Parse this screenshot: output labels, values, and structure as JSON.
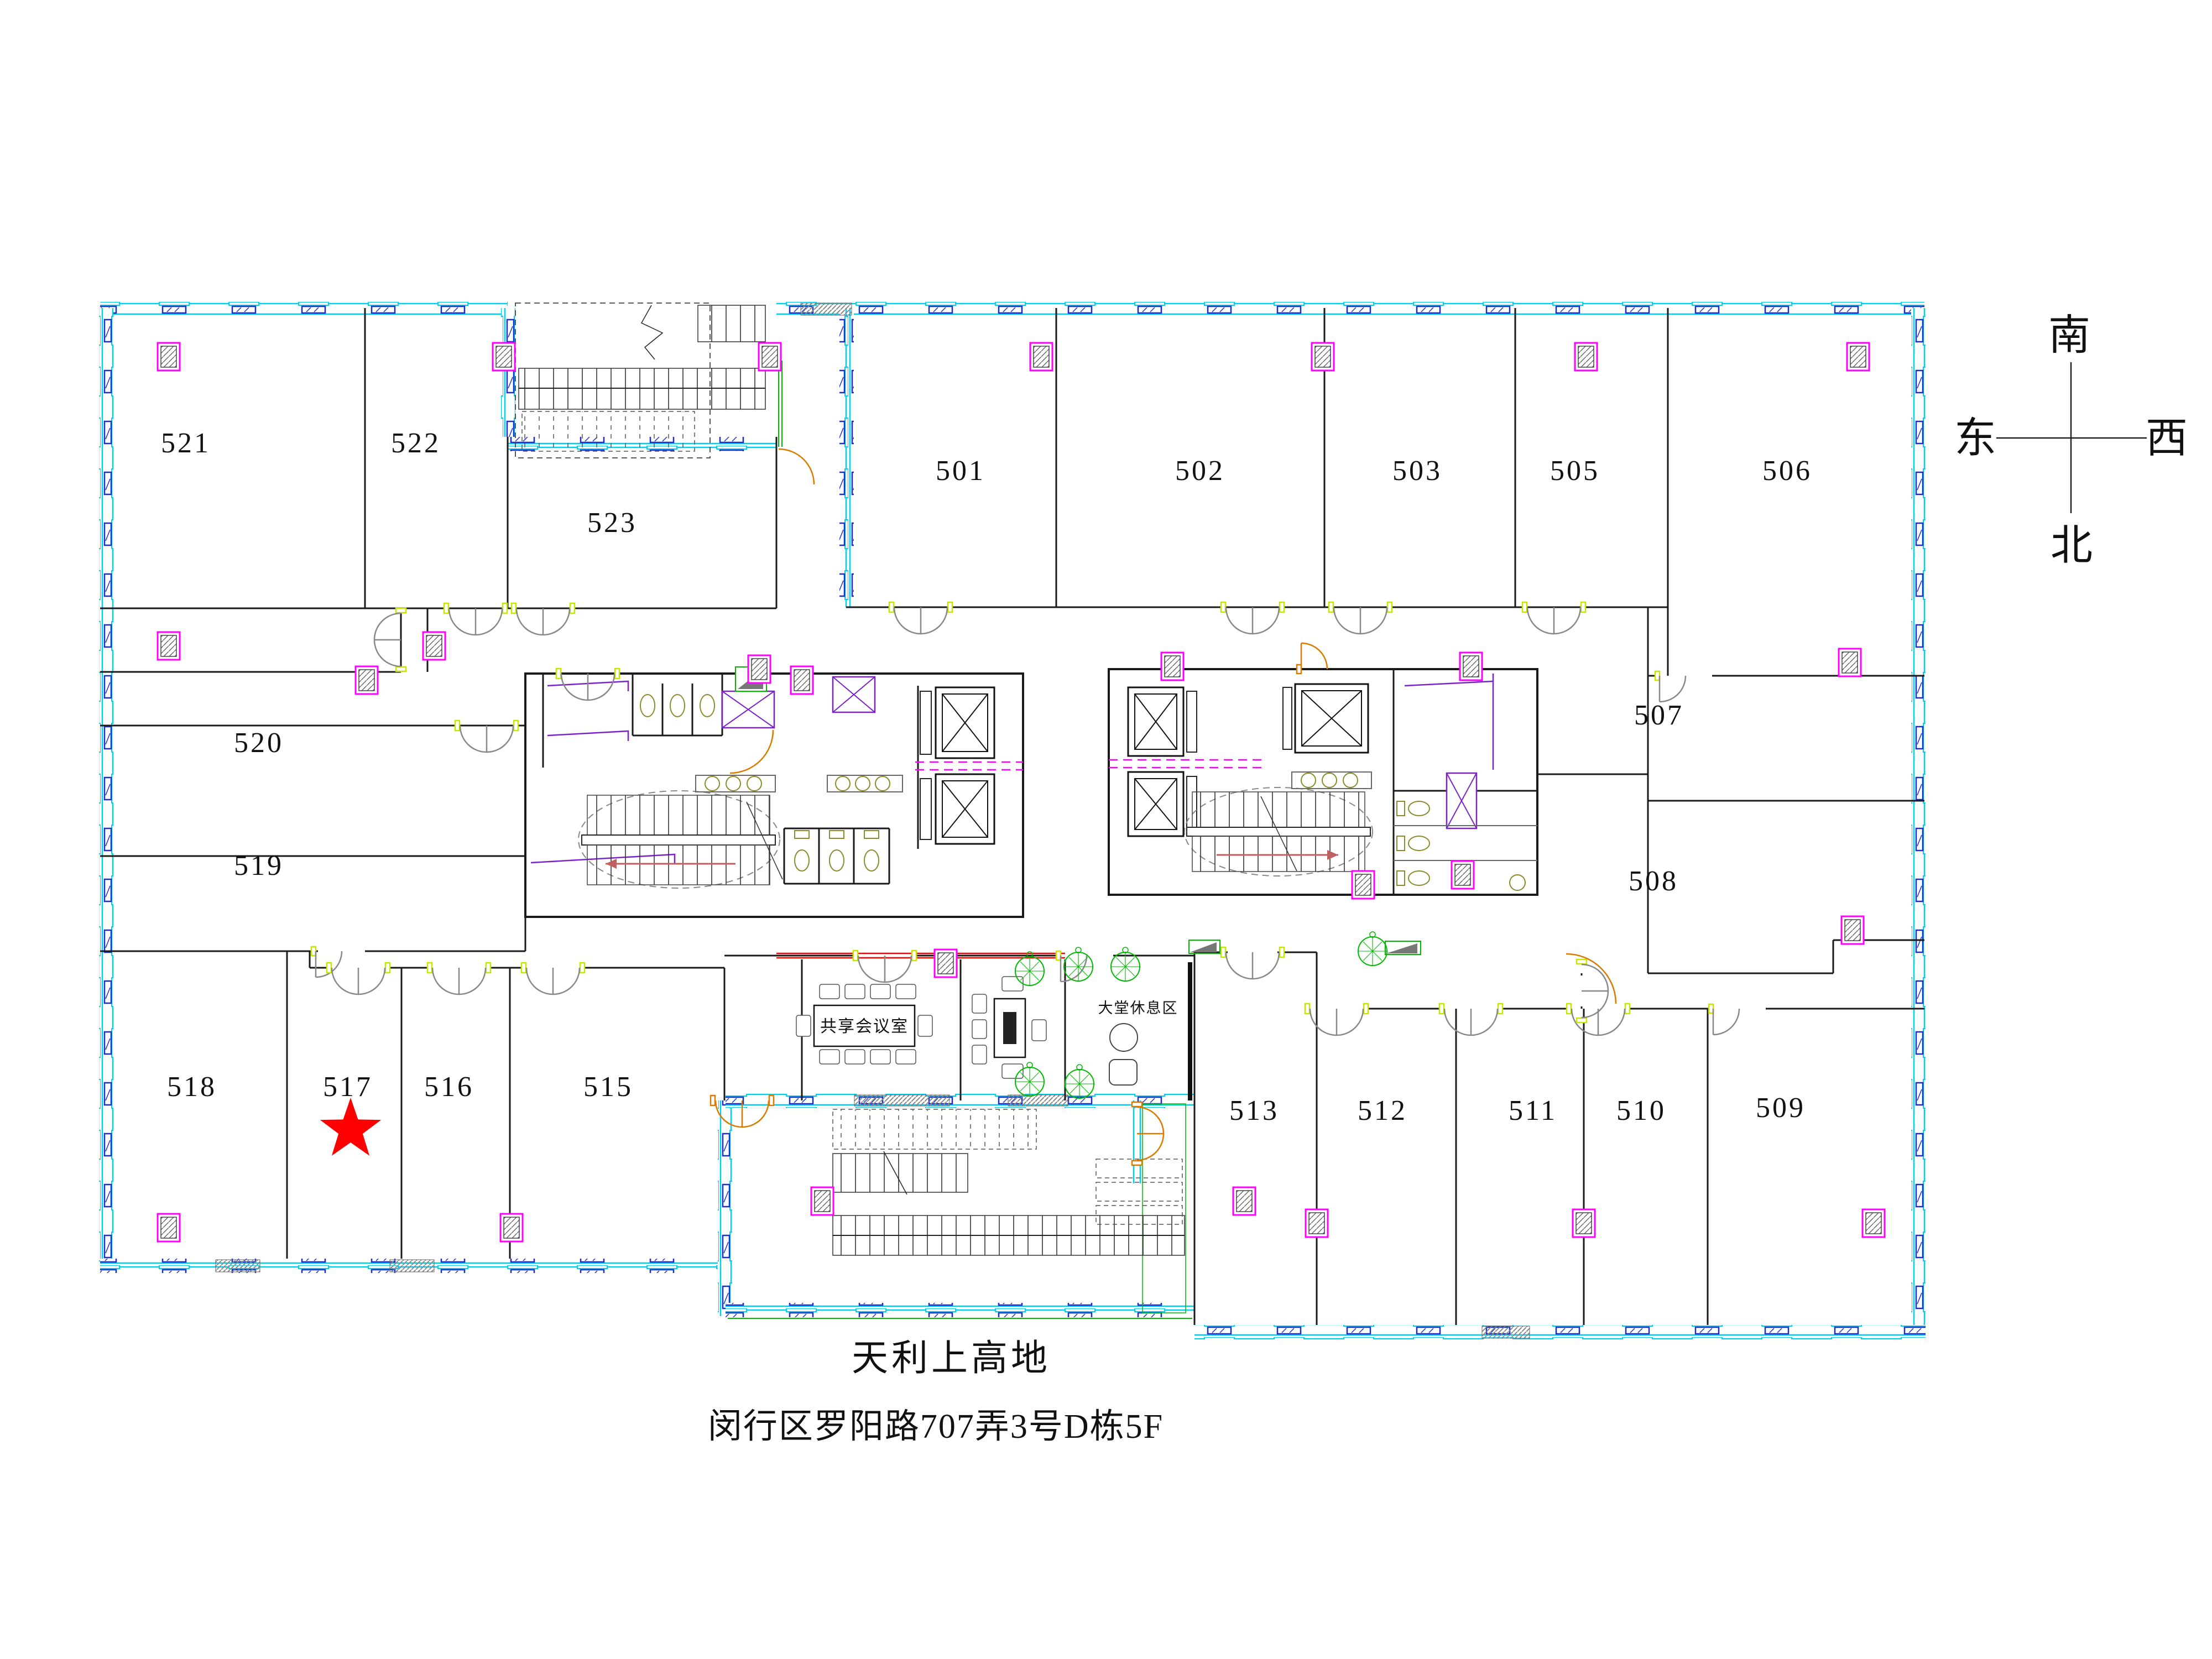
{
  "title": {
    "line1": "天利上高地",
    "line2": "闵行区罗阳路707弄3号D栋5F"
  },
  "compass": {
    "south": "南",
    "east": "东",
    "west": "西",
    "north": "北"
  },
  "rooms": {
    "501": "501",
    "502": "502",
    "503": "503",
    "505": "505",
    "506": "506",
    "507": "507",
    "508": "508",
    "509": "509",
    "510": "510",
    "511": "511",
    "512": "512",
    "513": "513",
    "515": "515",
    "516": "516",
    "517": "517",
    "518": "518",
    "519": "519",
    "520": "520",
    "521": "521",
    "522": "522",
    "523": "523"
  },
  "areas": {
    "meeting_room": "共享会议室",
    "lobby_rest": "大堂休息区"
  },
  "marker": {
    "type": "star",
    "room": "517",
    "color": "#FF0000"
  },
  "colors": {
    "exterior_wall": "#00CFEF",
    "window_frame": "#1A2FCC",
    "column": "#FF00FF",
    "door_jamb": "#C8E500",
    "door_alt": "#D97B00",
    "wall": "#1A1A1A",
    "highlight_red": "#FF0000",
    "accent_green": "#00B800",
    "accent_purple": "#7A22CC",
    "fixture_olive": "#8A8A2A"
  }
}
